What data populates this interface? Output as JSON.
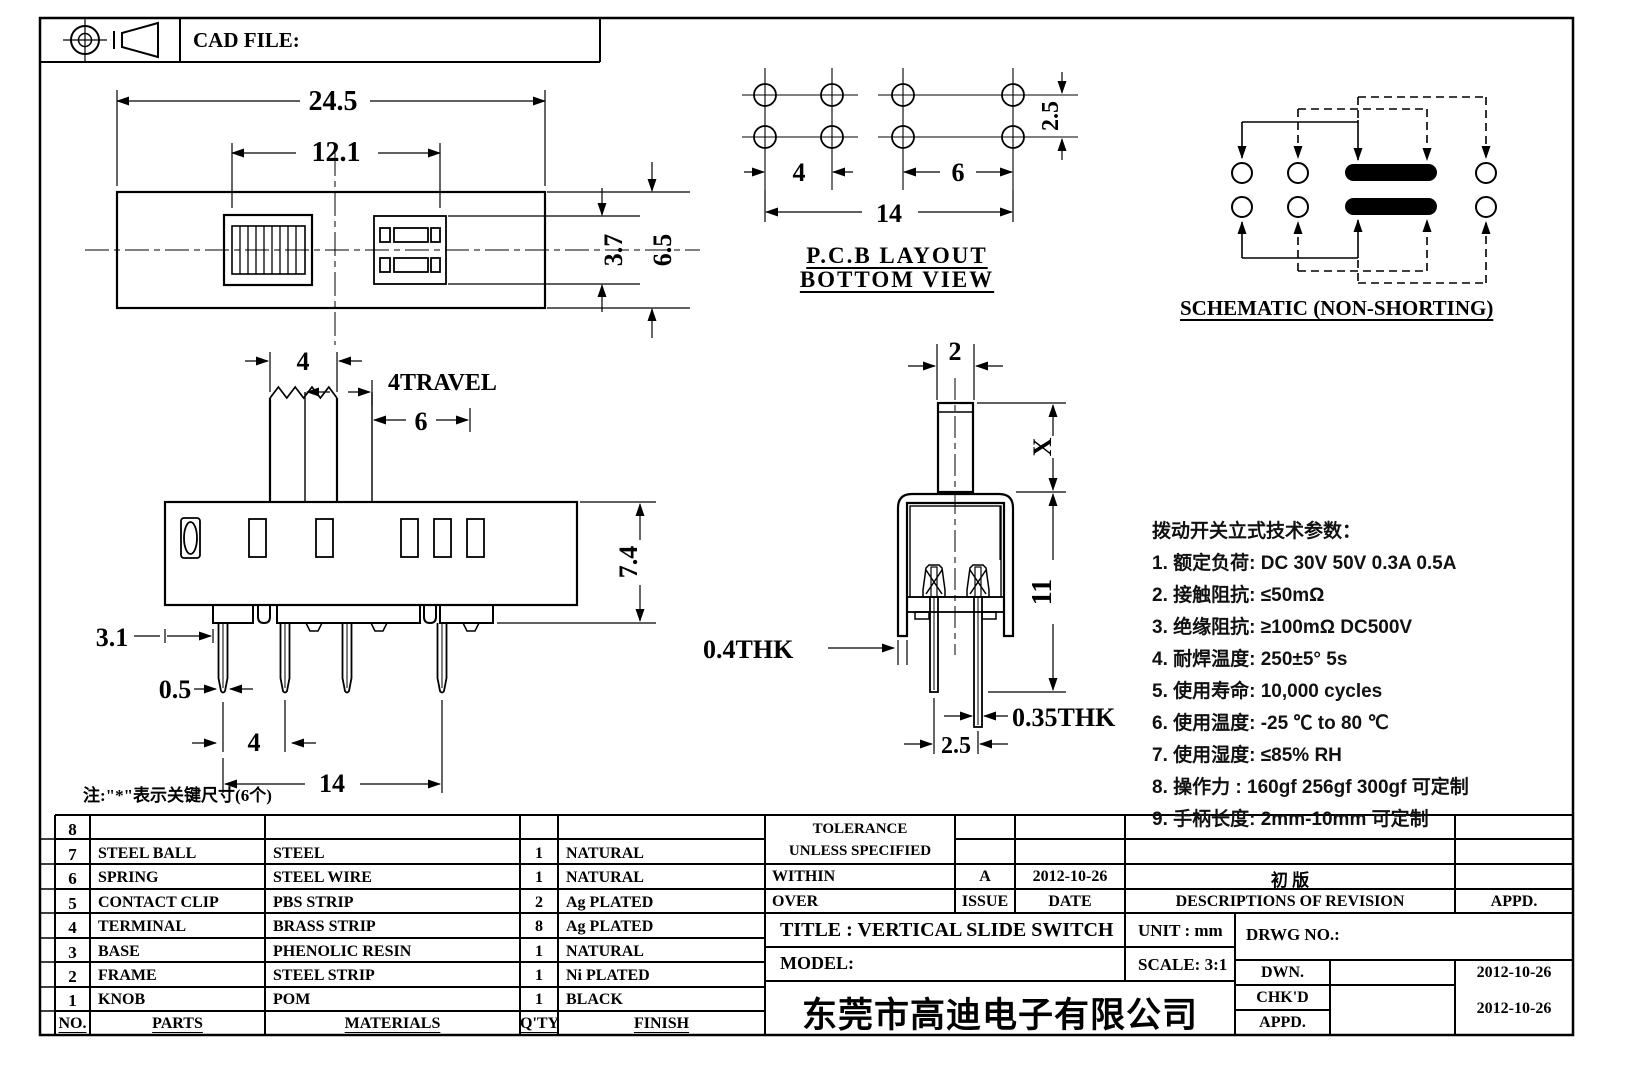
{
  "header": {
    "cad_file_label": "CAD FILE:"
  },
  "top_view": {
    "dim_overall": "24.5",
    "dim_inner": "12.1",
    "dim_slot": "3.7",
    "dim_height": "6.5"
  },
  "pcb": {
    "dim_pitch_left": "4",
    "dim_pitch_right": "6",
    "dim_span": "14",
    "dim_row": "2.5",
    "title_line1": "P.C.B LAYOUT",
    "title_line2": "BOTTOM VIEW"
  },
  "schematic": {
    "title": "SCHEMATIC (NON-SHORTING)"
  },
  "side_view": {
    "dim_knob": "4",
    "dim_travel": "4TRAVEL",
    "dim_travel_span": "6",
    "dim_height": "7.4",
    "dim_edge": "3.1",
    "dim_pin_thk": "0.5",
    "dim_pin_pitch": "4",
    "dim_pin_span": "14"
  },
  "front_view": {
    "dim_knob_w": "2",
    "dim_knob_h": "X",
    "dim_body_h": "11",
    "dim_frame_thk": "0.4THK",
    "dim_pin_thk": "0.35THK",
    "dim_pin_pitch": "2.5"
  },
  "note": "注:\"*\"表示关键尺寸(6个)",
  "specs": {
    "title": "拨动开关立式技术参数：",
    "items": [
      "1.  额定负荷: DC 30V    50V    0.3A    0.5A",
      "2.  接触阻抗:  ≤50mΩ",
      "3.  绝缘阻抗:  ≥100mΩ   DC500V",
      "4.  耐焊温度: 250±5°  5s",
      "5.  使用寿命: 10,000 cycles",
      "6.  使用温度: -25  ℃  to 80  ℃",
      "7.  使用湿度:  ≤85% RH",
      "8.  操作力 : 160gf   256gf   300gf  可定制",
      "9.  手柄长度: 2mm-10mm  可定制"
    ]
  },
  "parts_table": {
    "headers": [
      "NO.",
      "PARTS",
      "MATERIALS",
      "Q'TY",
      "FINISH"
    ],
    "rows": [
      [
        "8",
        "",
        "",
        "",
        ""
      ],
      [
        "7",
        "STEEL BALL",
        "STEEL",
        "1",
        "NATURAL"
      ],
      [
        "6",
        "SPRING",
        "STEEL WIRE",
        "1",
        "NATURAL"
      ],
      [
        "5",
        "CONTACT CLIP",
        "PBS STRIP",
        "2",
        "Ag PLATED"
      ],
      [
        "4",
        "TERMINAL",
        "BRASS STRIP",
        "8",
        "Ag PLATED"
      ],
      [
        "3",
        "BASE",
        "PHENOLIC RESIN",
        "1",
        "NATURAL"
      ],
      [
        "2",
        "FRAME",
        "STEEL STRIP",
        "1",
        "Ni PLATED"
      ],
      [
        "1",
        "KNOB",
        "POM",
        "1",
        "BLACK"
      ]
    ]
  },
  "title_block": {
    "tolerance_line1": "TOLERANCE",
    "tolerance_line2": "UNLESS   SPECIFIED",
    "within_label": "WITHIN",
    "over_label": "OVER",
    "issue_value": "A",
    "issue_label": "ISSUE",
    "date_value": "2012-10-26",
    "date_label": "DATE",
    "revision_value": "初  版",
    "revision_label": "DESCRIPTIONS OF REVISION",
    "appd_col_label": "APPD.",
    "title_label": "TITLE :   VERTICAL SLIDE SWITCH",
    "unit_label": "UNIT :   mm",
    "model_label": "MODEL:",
    "scale_label": "SCALE:   3:1",
    "drwg_label": "DRWG NO.:",
    "dwn_label": "DWN.",
    "dwn_date": "2012-10-26",
    "chkd_label": "CHK'D",
    "appd_label": "APPD.",
    "chkd_appd_date": "2012-10-26",
    "company": "东莞市高迪电子有限公司"
  }
}
